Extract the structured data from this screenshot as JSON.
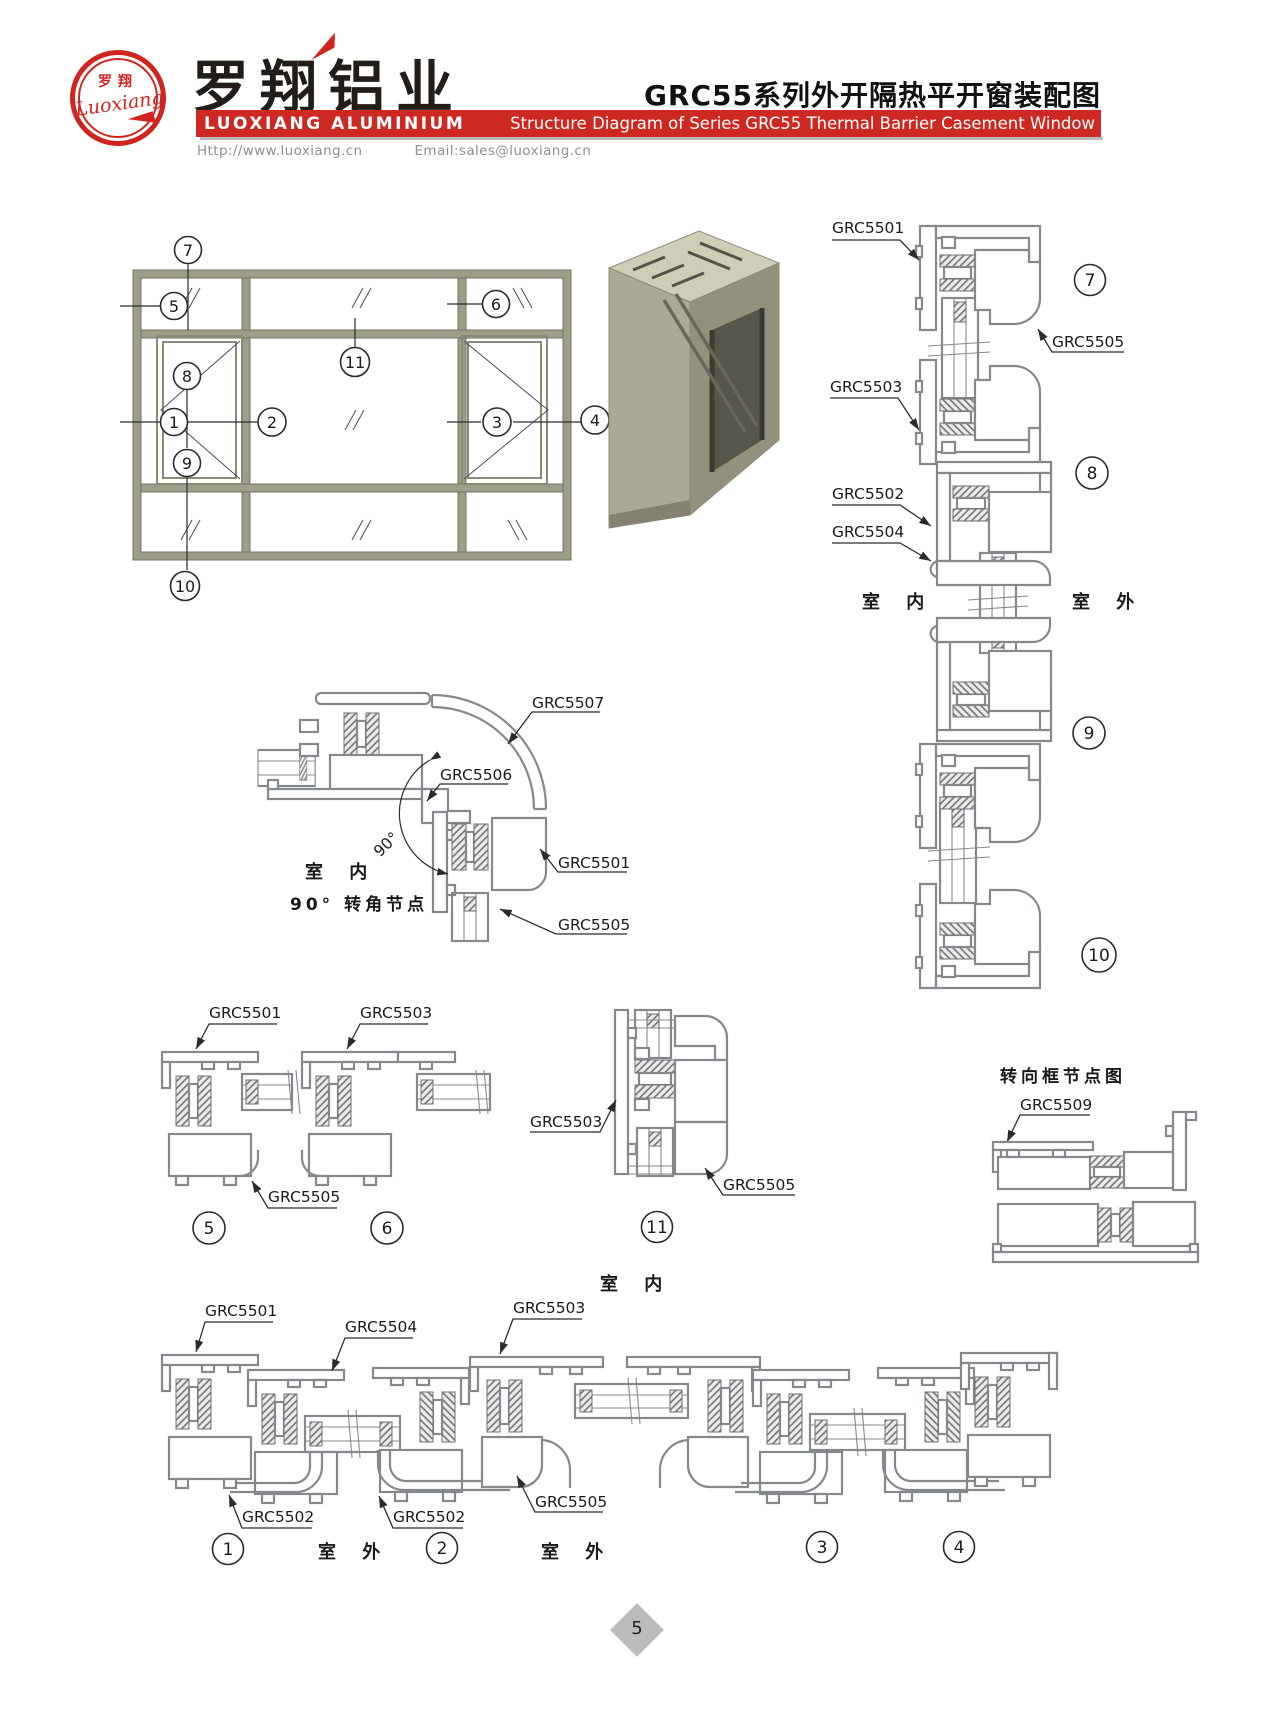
{
  "header": {
    "logo": {
      "cn": "罗翔",
      "script": "Luoxiang"
    },
    "company_cn": "罗翔铝业",
    "company_en": "LUOXIANG ALUMINIUM",
    "website": "Http://www.luoxiang.cn",
    "email": "Email:sales@luoxiang.cn",
    "title_cn": "GRC55系列外开隔热平开窗装配图",
    "title_en": "Structure Diagram of Series GRC55 Thermal Barrier Casement Window"
  },
  "parts": {
    "p5501": "GRC5501",
    "p5502": "GRC5502",
    "p5503": "GRC5503",
    "p5504": "GRC5504",
    "p5505": "GRC5505",
    "p5506": "GRC5506",
    "p5507": "GRC5507",
    "p5509": "GRC5509"
  },
  "callouts": {
    "n1": "1",
    "n2": "2",
    "n3": "3",
    "n4": "4",
    "n5": "5",
    "n6": "6",
    "n7": "7",
    "n8": "8",
    "n9": "9",
    "n10": "10",
    "n11": "11"
  },
  "texts": {
    "indoor": "室 内",
    "outdoor": "室 外",
    "angle": "90°",
    "corner_caption": "90°  转角节点",
    "turn_frame_title": "转向框节点图"
  },
  "colors": {
    "brand_red": "#ce2823",
    "line_gray": "#85898e",
    "frame_olive": "#9e9d89"
  },
  "footer": {
    "page": "5"
  }
}
